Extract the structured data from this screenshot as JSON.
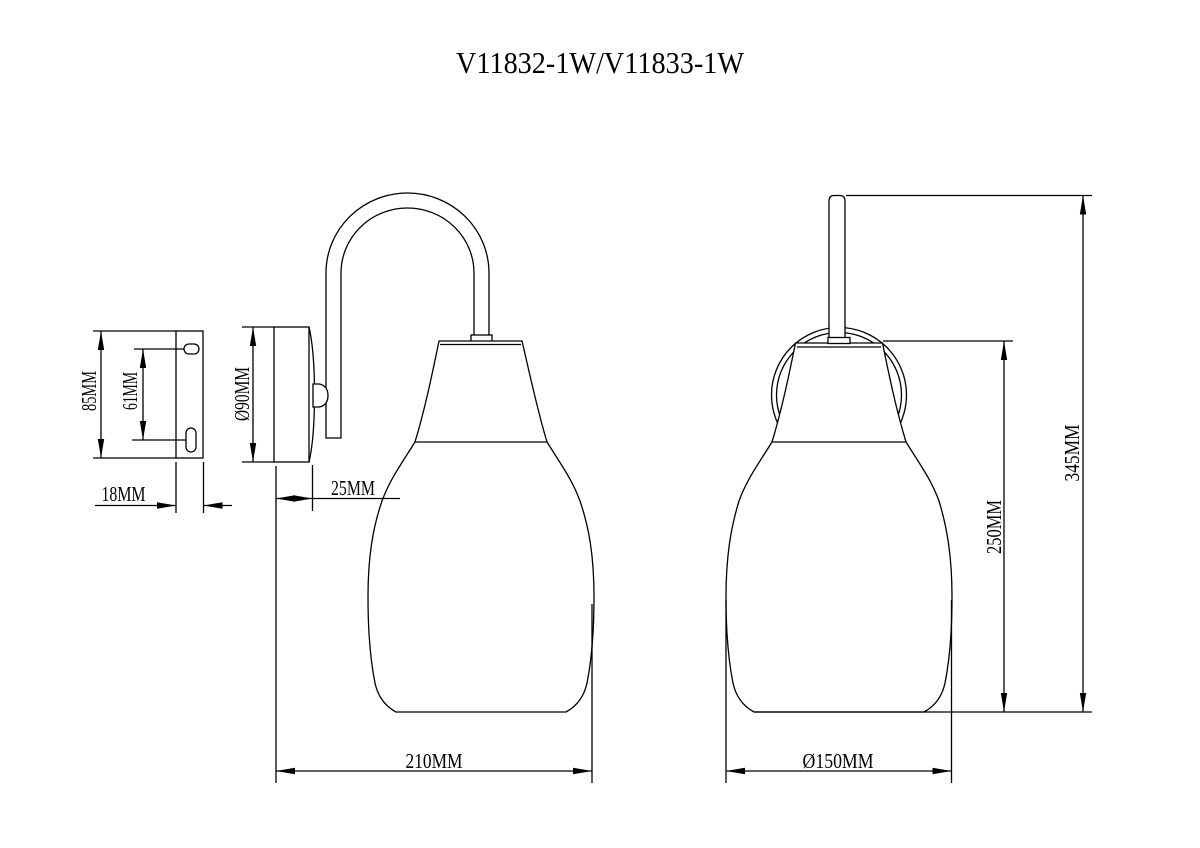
{
  "title": "V11832-1W/V11833-1W",
  "views": {
    "bracket": {
      "name": "mounting-bracket-profile",
      "height": "85MM",
      "slot_spacing": "61MM",
      "depth": "18MM"
    },
    "side": {
      "name": "lamp-side-view",
      "backplate_diameter": "Ø90MM",
      "backplate_depth": "25MM",
      "projection": "210MM"
    },
    "front": {
      "name": "lamp-front-view",
      "overall_height": "345MM",
      "shade_height": "250MM",
      "shade_diameter": "Ø150MM"
    }
  },
  "colors": {
    "line": "#000000",
    "background": "#ffffff"
  }
}
